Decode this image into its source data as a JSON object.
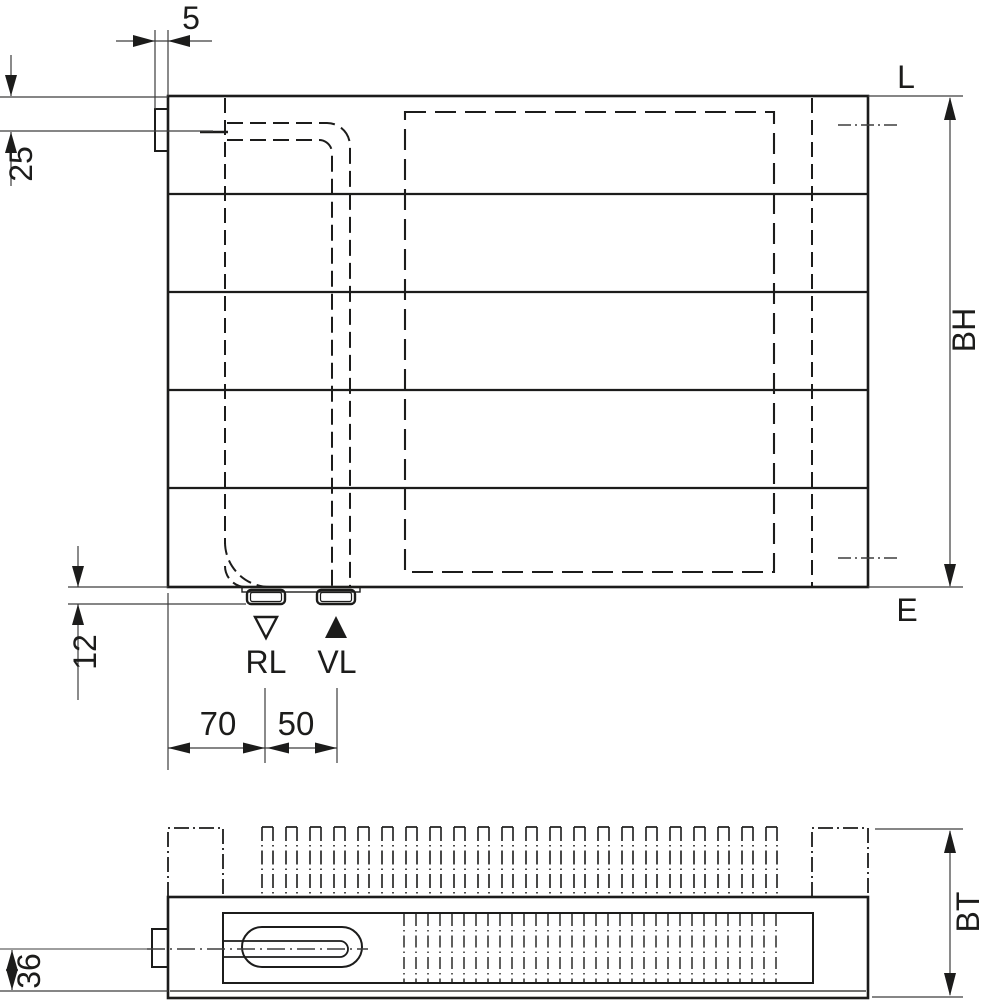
{
  "front_view": {
    "dims": {
      "bracket_width": "5",
      "inlet_offset": "25",
      "stub_height": "12",
      "edge_to_return": "70",
      "return_to_supply": "50"
    },
    "labels": {
      "top_edge": "L",
      "bottom_edge": "E",
      "height": "BH",
      "return_port": "RL",
      "supply_port": "VL"
    }
  },
  "plan_view": {
    "dims": {
      "center_to_face": "36"
    },
    "labels": {
      "depth": "BT"
    }
  },
  "colors": {
    "line": "#1c1c1b",
    "thin_line": "#3d3d3d",
    "background": "#ffffff"
  }
}
